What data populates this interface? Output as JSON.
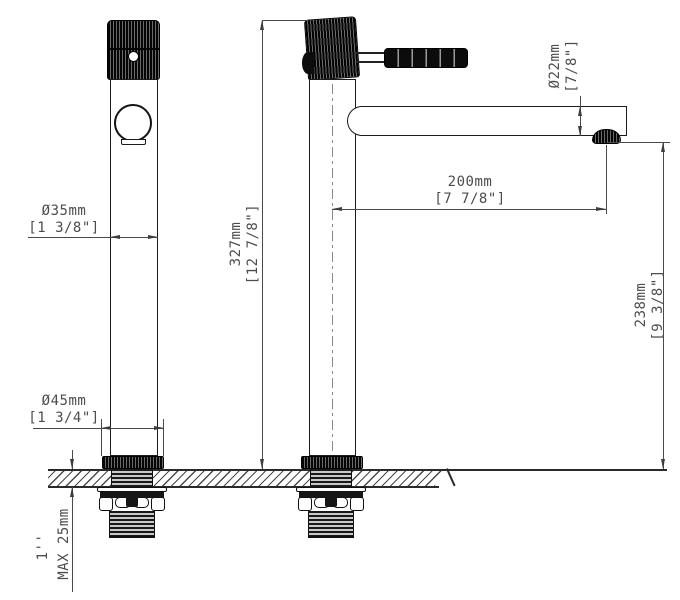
{
  "drawing": {
    "subject": "tall single-lever basin faucet installation drawing, front and side views"
  },
  "dimensions": {
    "body_diameter": {
      "metric": "Ø35mm",
      "imperial": "[1 3/8\"]"
    },
    "base_diameter": {
      "metric": "Ø45mm",
      "imperial": "[1 3/4\"]"
    },
    "overall_height": {
      "metric": "327mm",
      "imperial": "[12 7/8\"]"
    },
    "spout_diameter": {
      "metric": "Ø22mm",
      "imperial": "[7/8\"]"
    },
    "spout_reach": {
      "metric": "200mm",
      "imperial": "[7 7/8\"]"
    },
    "spout_clearance": {
      "metric": "238mm",
      "imperial": "[9 3/8\"]"
    },
    "deck_thickness": {
      "thread_size": "1''",
      "max_label": "MAX 25mm"
    }
  }
}
